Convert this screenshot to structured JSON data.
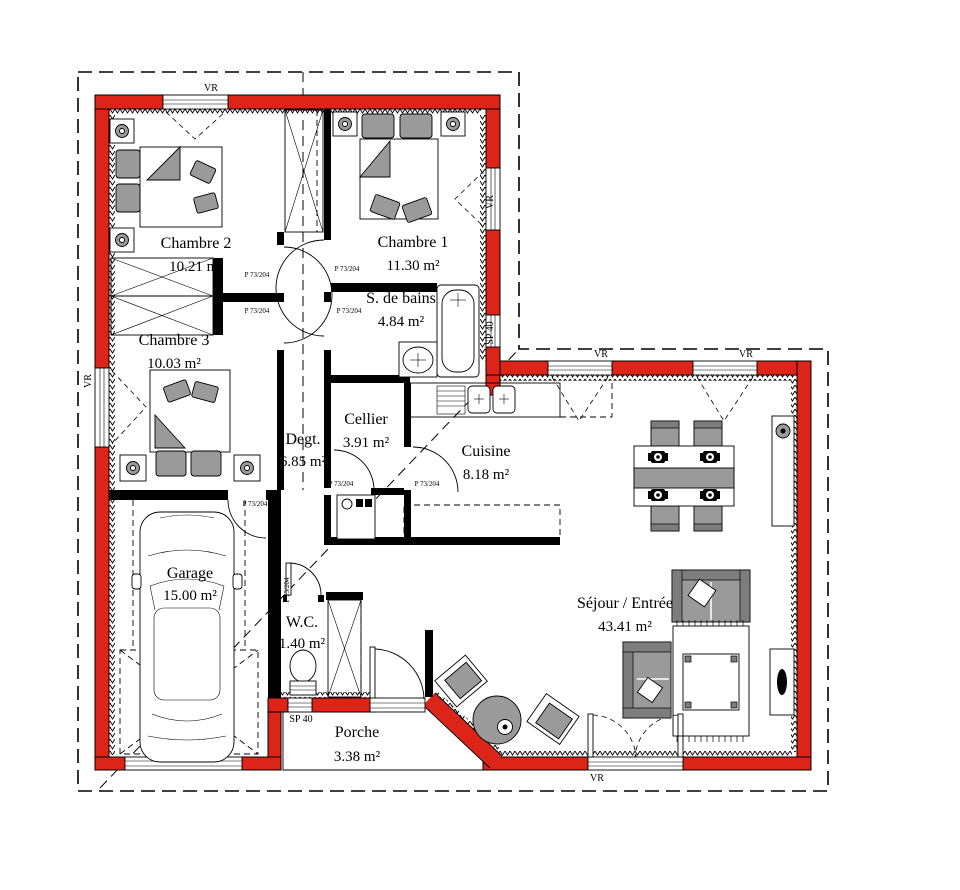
{
  "document": {
    "type": "house-floor-plan"
  },
  "colors": {
    "wall_red": "#dd2418",
    "furniture_gray": "#9a9a9a",
    "line_black": "#000000"
  },
  "rooms": [
    {
      "name": "Chambre 2",
      "area": "10.21 m²"
    },
    {
      "name": "Chambre 1",
      "area": "11.30 m²"
    },
    {
      "name": "Chambre 3",
      "area": "10.03 m²"
    },
    {
      "name": "S. de bains",
      "area": "4.84 m²"
    },
    {
      "name": "Degt.",
      "area": "6.85 m²"
    },
    {
      "name": "Cellier",
      "area": "3.91 m²"
    },
    {
      "name": "Cuisine",
      "area": "8.18 m²"
    },
    {
      "name": "Garage",
      "area": "15.00 m²"
    },
    {
      "name": "W.C.",
      "area": "1.40 m²"
    },
    {
      "name": "Porche",
      "area": "3.38 m²"
    },
    {
      "name": "Séjour / Entrée",
      "area": "43.41 m²"
    }
  ],
  "annotations": {
    "roller_shutter": "VR",
    "small_window": "SP 40",
    "door_spec": "P 73/204"
  }
}
